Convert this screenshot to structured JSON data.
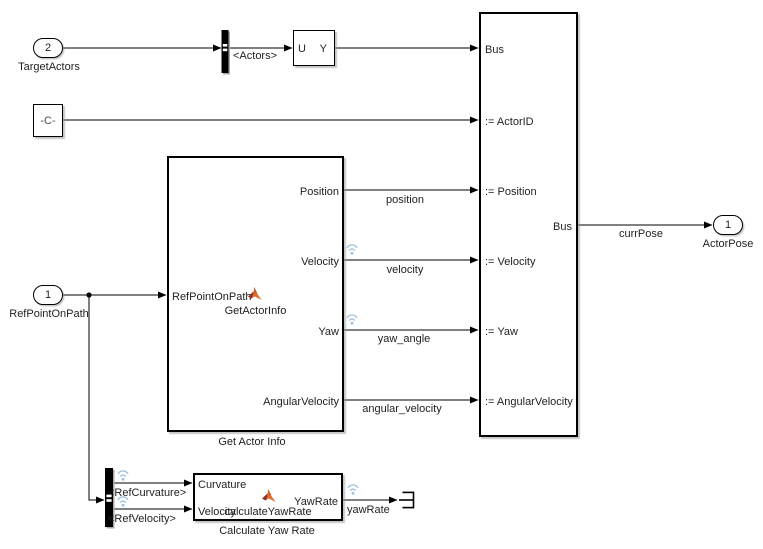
{
  "colors": {
    "wire": "#000000",
    "badge_blue": "#9fc2e2",
    "matlab_orange": "#e06b2c",
    "matlab_maroon": "#8a3324"
  },
  "ports": {
    "target_actors": {
      "num": "2",
      "label": "TargetActors"
    },
    "ref_point": {
      "num": "1",
      "label": "RefPointOnPath"
    },
    "actor_pose": {
      "num": "1",
      "label": "ActorPose"
    }
  },
  "constant": {
    "value": "-C-"
  },
  "signal_conversion": {
    "u": "U",
    "y": "Y"
  },
  "bus_selector_top": {
    "tag": "<Actors>"
  },
  "bus_selector_bottom": {
    "tag1": "<RefCurvature>",
    "tag2": "<RefVelocity>"
  },
  "get_actor_info": {
    "fn": "GetActorInfo",
    "caption": "Get Actor Info",
    "in1": "RefPointOnPath",
    "out1": "Position",
    "out2": "Velocity",
    "out3": "Yaw",
    "out4": "AngularVelocity"
  },
  "bus_assignment": {
    "in1": "Bus",
    "in2": ":= ActorID",
    "in3": ":= Position",
    "in4": ":= Velocity",
    "in5": ":= Yaw",
    "in6": ":= AngularVelocity",
    "out": "Bus"
  },
  "calc_yaw_rate": {
    "fn": "calculateYawRate",
    "caption": "Calculate Yaw Rate",
    "in1": "Curvature",
    "in2": "Velocity",
    "out": "YawRate"
  },
  "signals": {
    "position": "position",
    "velocity": "velocity",
    "yaw_angle": "yaw_angle",
    "angular_velocity": "angular_velocity",
    "curr_pose": "currPose",
    "yaw_rate": "yawRate"
  }
}
